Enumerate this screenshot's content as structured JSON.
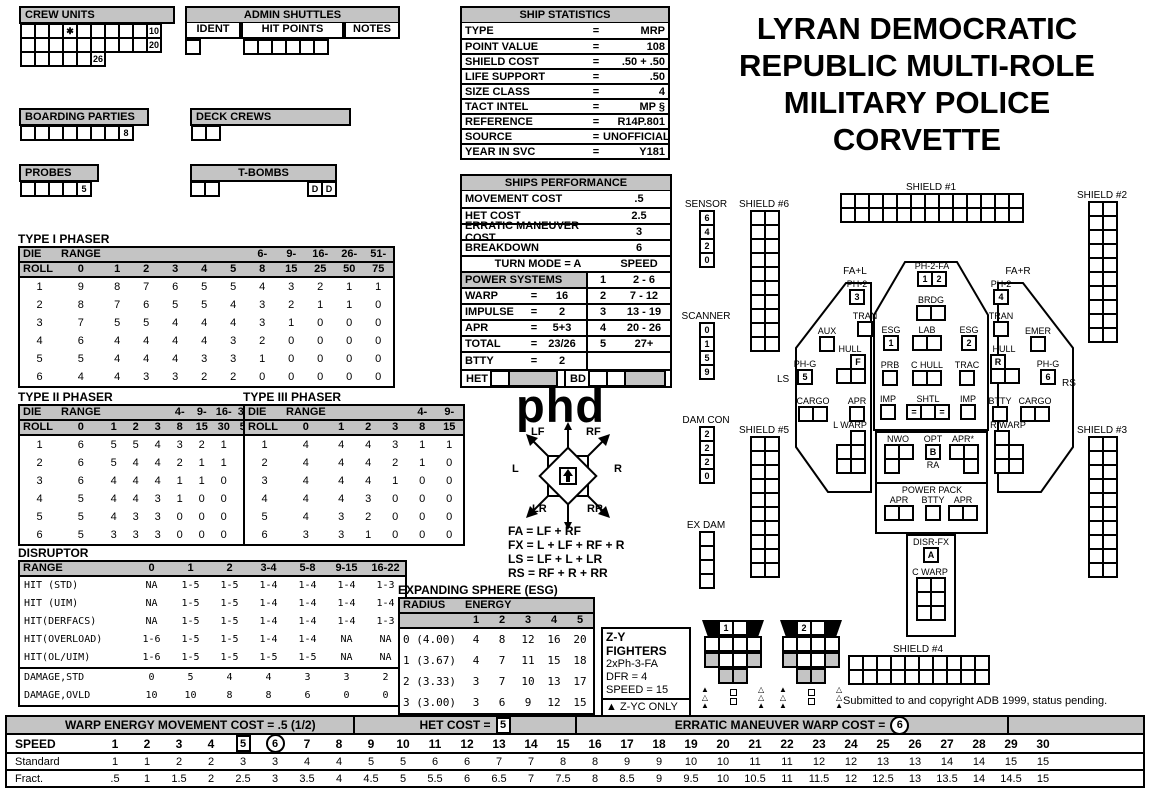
{
  "title_lines": [
    "LYRAN DEMOCRATIC",
    "REPUBLIC MULTI-ROLE",
    "MILITARY POLICE",
    "CORVETTE"
  ],
  "logo": "phd",
  "copyright": "Submitted to and copyright ADB 1999, status pending.",
  "panels": {
    "crew_units": {
      "title": "CREW UNITS",
      "row1": [
        "",
        "",
        "",
        "✱",
        "",
        "",
        "",
        "",
        "",
        "10"
      ],
      "row2": [
        "",
        "",
        "",
        "",
        "",
        "",
        "",
        "",
        "",
        "20"
      ],
      "row3": [
        "",
        "",
        "",
        "",
        "",
        "26"
      ]
    },
    "admin_shuttles": {
      "title": "ADMIN SHUTTLES",
      "col1": "IDENT",
      "col2": "HIT POINTS",
      "col3": "NOTES",
      "ident_cells": [
        ""
      ],
      "hit_cells": [
        "",
        "",
        "",
        "",
        "",
        ""
      ]
    },
    "boarding_parties": {
      "title": "BOARDING PARTIES",
      "cells": [
        "",
        "",
        "",
        "",
        "",
        "",
        "",
        "8"
      ]
    },
    "deck_crews": {
      "title": "DECK CREWS",
      "cells": [
        "",
        ""
      ]
    },
    "probes": {
      "title": "PROBES",
      "cells": [
        "",
        "",
        "",
        "",
        "5"
      ]
    },
    "t_bombs": {
      "title": "T-BOMBS",
      "left": [
        "",
        ""
      ],
      "right": [
        "D",
        "D"
      ]
    }
  },
  "ship_stats": {
    "title": "SHIP STATISTICS",
    "rows": [
      [
        "TYPE",
        "=",
        "MRP"
      ],
      [
        "POINT VALUE",
        "=",
        "108"
      ],
      [
        "SHIELD COST",
        "=",
        ".50 + .50"
      ],
      [
        "LIFE SUPPORT",
        "=",
        ".50"
      ],
      [
        "SIZE CLASS",
        "=",
        "4"
      ],
      [
        "TACT INTEL",
        "=",
        "MP §"
      ],
      [
        "REFERENCE",
        "=",
        "R14P.801"
      ],
      [
        "SOURCE",
        "=",
        "UNOFFICIAL"
      ],
      [
        "YEAR IN SVC",
        "=",
        "Y181"
      ]
    ]
  },
  "performance": {
    "title": "SHIPS PERFORMANCE",
    "rows": [
      [
        "MOVEMENT COST",
        ".5"
      ],
      [
        "HET COST",
        "2.5"
      ],
      [
        "ERRATIC MANEUVER COST",
        "3"
      ],
      [
        "BREAKDOWN",
        "6"
      ]
    ],
    "turn_mode": "TURN MODE = A",
    "speed": "SPEED",
    "power_header": "POWER SYSTEMS",
    "power_rows": [
      [
        "WARP",
        "=",
        "16"
      ],
      [
        "IMPULSE",
        "=",
        "2"
      ],
      [
        "APR",
        "=",
        "5+3"
      ],
      [
        "TOTAL",
        "=",
        "23/26"
      ],
      [
        "BTTY",
        "=",
        "2"
      ]
    ],
    "turn_rows": [
      [
        "1",
        "2 - 6"
      ],
      [
        "2",
        "7 - 12"
      ],
      [
        "3",
        "13 - 19"
      ],
      [
        "4",
        "20 - 26"
      ],
      [
        "5",
        "27+"
      ]
    ],
    "het": "HET",
    "bd": "BD"
  },
  "phaser1": {
    "title": "TYPE I PHASER",
    "ht": [
      "DIE",
      "RANGE",
      "",
      "",
      "",
      "",
      "",
      "6-",
      "9-",
      "16-",
      "26-",
      "51-"
    ],
    "hb": [
      "ROLL",
      "0",
      "1",
      "2",
      "3",
      "4",
      "5",
      "8",
      "15",
      "25",
      "50",
      "75"
    ],
    "rows": [
      [
        "1",
        "9",
        "8",
        "7",
        "6",
        "5",
        "5",
        "4",
        "3",
        "2",
        "1",
        "1"
      ],
      [
        "2",
        "8",
        "7",
        "6",
        "5",
        "5",
        "4",
        "3",
        "2",
        "1",
        "1",
        "0"
      ],
      [
        "3",
        "7",
        "5",
        "5",
        "4",
        "4",
        "4",
        "3",
        "1",
        "0",
        "0",
        "0"
      ],
      [
        "4",
        "6",
        "4",
        "4",
        "4",
        "4",
        "3",
        "2",
        "0",
        "0",
        "0",
        "0"
      ],
      [
        "5",
        "5",
        "4",
        "4",
        "4",
        "3",
        "3",
        "1",
        "0",
        "0",
        "0",
        "0"
      ],
      [
        "6",
        "4",
        "4",
        "3",
        "3",
        "2",
        "2",
        "0",
        "0",
        "0",
        "0",
        "0"
      ]
    ]
  },
  "phaser2": {
    "title": "TYPE II PHASER",
    "ht": [
      "DIE",
      "RANGE",
      "",
      "",
      "",
      "4-",
      "9-",
      "16-",
      "31-"
    ],
    "hb": [
      "ROLL",
      "0",
      "1",
      "2",
      "3",
      "8",
      "15",
      "30",
      "50"
    ],
    "rows": [
      [
        "1",
        "6",
        "5",
        "5",
        "4",
        "3",
        "2",
        "1",
        "1"
      ],
      [
        "2",
        "6",
        "5",
        "4",
        "4",
        "2",
        "1",
        "1",
        "0"
      ],
      [
        "3",
        "6",
        "4",
        "4",
        "4",
        "1",
        "1",
        "0",
        "0"
      ],
      [
        "4",
        "5",
        "4",
        "4",
        "3",
        "1",
        "0",
        "0",
        "0"
      ],
      [
        "5",
        "5",
        "4",
        "3",
        "3",
        "0",
        "0",
        "0",
        "0"
      ],
      [
        "6",
        "5",
        "3",
        "3",
        "3",
        "0",
        "0",
        "0",
        "0"
      ]
    ]
  },
  "phaser3": {
    "title": "TYPE III PHASER",
    "ht": [
      "DIE",
      "RANGE",
      "",
      "",
      "",
      "4-",
      "9-"
    ],
    "hb": [
      "ROLL",
      "0",
      "1",
      "2",
      "3",
      "8",
      "15"
    ],
    "rows": [
      [
        "1",
        "4",
        "4",
        "4",
        "3",
        "1",
        "1"
      ],
      [
        "2",
        "4",
        "4",
        "4",
        "2",
        "1",
        "0"
      ],
      [
        "3",
        "4",
        "4",
        "4",
        "1",
        "0",
        "0"
      ],
      [
        "4",
        "4",
        "4",
        "3",
        "0",
        "0",
        "0"
      ],
      [
        "5",
        "4",
        "3",
        "2",
        "0",
        "0",
        "0"
      ],
      [
        "6",
        "3",
        "3",
        "1",
        "0",
        "0",
        "0"
      ]
    ]
  },
  "disruptor": {
    "title": "DISRUPTOR",
    "sep": 5,
    "headers": [
      "RANGE",
      "0",
      "1",
      "2",
      "3-4",
      "5-8",
      "9-15",
      "16-22"
    ],
    "rows": [
      [
        "HIT (STD)",
        "NA",
        "1-5",
        "1-5",
        "1-4",
        "1-4",
        "1-4",
        "1-3"
      ],
      [
        "HIT (UIM)",
        "NA",
        "1-5",
        "1-5",
        "1-4",
        "1-4",
        "1-4",
        "1-4"
      ],
      [
        "HIT(DERFACS)",
        "NA",
        "1-5",
        "1-5",
        "1-4",
        "1-4",
        "1-4",
        "1-3"
      ],
      [
        "HIT(OVERLOAD)",
        "1-6",
        "1-5",
        "1-5",
        "1-4",
        "1-4",
        "NA",
        "NA"
      ],
      [
        "HIT(OL/UIM)",
        "1-6",
        "1-5",
        "1-5",
        "1-5",
        "1-5",
        "NA",
        "NA"
      ],
      [
        "DAMAGE,STD",
        "0",
        "5",
        "4",
        "4",
        "3",
        "3",
        "2"
      ],
      [
        "DAMAGE,OVLD",
        "10",
        "10",
        "8",
        "8",
        "6",
        "0",
        "0"
      ]
    ]
  },
  "esg": {
    "title": "EXPANDING SPHERE (ESG)",
    "h1": "RADIUS",
    "h2": "ENERGY",
    "cols": [
      "1",
      "2",
      "3",
      "4",
      "5"
    ],
    "rows": [
      [
        "0 (4.00)",
        "4",
        "8",
        "12",
        "16",
        "20"
      ],
      [
        "1 (3.67)",
        "4",
        "7",
        "11",
        "15",
        "18"
      ],
      [
        "2 (3.33)",
        "3",
        "7",
        "10",
        "13",
        "17"
      ],
      [
        "3 (3.00)",
        "3",
        "6",
        "9",
        "12",
        "15"
      ]
    ]
  },
  "rose": {
    "lf": "LF",
    "rf": "RF",
    "l": "L",
    "r": "R",
    "lr": "LR",
    "rr": "RR"
  },
  "formulas": [
    "FA = LF + RF",
    "FX = L + LF + RF + R",
    "LS = LF + L + LR",
    "RS = RF + R + RR"
  ],
  "trackers": {
    "sensor": {
      "label": "SENSOR",
      "grid": {
        "cols": 1,
        "rows": 4,
        "values": [
          "6",
          "4",
          "2",
          "0"
        ]
      }
    },
    "scanner": {
      "label": "SCANNER",
      "grid": {
        "cols": 1,
        "rows": 4,
        "values": [
          "0",
          "1",
          "5",
          "9"
        ]
      }
    },
    "dam_con": {
      "label": "DAM CON",
      "grid": {
        "cols": 1,
        "rows": 4,
        "values": [
          "2",
          "2",
          "2",
          "0"
        ]
      }
    },
    "ex_dam": {
      "label": "EX DAM",
      "grid": {
        "cols": 1,
        "rows": 4,
        "values": [
          "",
          "",
          "",
          ""
        ]
      }
    }
  },
  "shields": {
    "s1": {
      "label": "SHIELD #1",
      "grid": {
        "cols": 13,
        "rows": 2
      }
    },
    "s2": {
      "label": "SHIELD #2",
      "grid": {
        "cols": 2,
        "rows": 10
      }
    },
    "s3": {
      "label": "SHIELD #3",
      "grid": {
        "cols": 2,
        "rows": 10
      }
    },
    "s4": {
      "label": "SHIELD #4",
      "grid": {
        "cols": 10,
        "rows": 2
      }
    },
    "s5": {
      "label": "SHIELD #5",
      "grid": {
        "cols": 2,
        "rows": 10
      }
    },
    "s6": {
      "label": "SHIELD #6",
      "grid": {
        "cols": 2,
        "rows": 10
      }
    }
  },
  "ship": {
    "arc_fal": "FA+L",
    "arc_far": "FA+R",
    "ls": "LS",
    "rs": "RS",
    "ph2_l": {
      "label": "PH-2",
      "cells": [
        "3"
      ]
    },
    "tran_l": {
      "label": "TRAN",
      "cells": [
        ""
      ]
    },
    "aux": {
      "label": "AUX",
      "cells": [
        ""
      ]
    },
    "hull_l": {
      "label": "HULL",
      "grid": {
        "cols": 2,
        "rows": 2,
        "values": [
          null,
          "F",
          "",
          ""
        ]
      }
    },
    "phg_l": {
      "label": "PH-G",
      "cells": [
        "5"
      ]
    },
    "cargo_l": {
      "label": "CARGO",
      "cells": [
        "",
        ""
      ]
    },
    "apr_l": {
      "label": "APR",
      "cells": [
        ""
      ]
    },
    "lwarp": {
      "label": "L WARP",
      "grid": {
        "cols": 2,
        "rows": 3,
        "values": [
          null,
          "",
          "",
          "",
          "",
          ""
        ]
      }
    },
    "ph2fa": {
      "label": "PH-2-FA",
      "cells": [
        "1",
        "2"
      ]
    },
    "brdg": {
      "label": "BRDG",
      "cells": [
        "",
        ""
      ]
    },
    "esg1": {
      "label": "ESG",
      "cells": [
        "1"
      ]
    },
    "lab": {
      "label": "LAB",
      "cells": [
        "",
        ""
      ]
    },
    "esg2": {
      "label": "ESG",
      "cells": [
        "2"
      ]
    },
    "prb": {
      "label": "PRB",
      "cells": [
        ""
      ]
    },
    "chull": {
      "label": "C HULL",
      "cells": [
        "",
        ""
      ]
    },
    "trac": {
      "label": "TRAC",
      "cells": [
        ""
      ]
    },
    "imp_l": {
      "label": "IMP",
      "cells": [
        ""
      ]
    },
    "shtl": {
      "label": "SHTL",
      "cells": [
        "=",
        "",
        "="
      ]
    },
    "imp_r": {
      "label": "IMP",
      "cells": [
        ""
      ]
    },
    "nwo": {
      "label": "NWO",
      "grid": {
        "cols": 2,
        "rows": 2,
        "values": [
          "",
          "",
          "",
          null
        ]
      }
    },
    "opt": {
      "label": "OPT",
      "cells": [
        "B"
      ],
      "sub": "RA"
    },
    "apr_star": {
      "label": "APR*",
      "grid": {
        "cols": 2,
        "rows": 2,
        "values": [
          "",
          "",
          null,
          ""
        ]
      }
    },
    "power_pack": {
      "label": "POWER PACK",
      "apr1": {
        "label": "APR",
        "cells": [
          "",
          ""
        ]
      },
      "btty": {
        "label": "BTTY",
        "cells": [
          ""
        ]
      },
      "apr2": {
        "label": "APR",
        "cells": [
          "",
          ""
        ]
      }
    },
    "disr_fx": {
      "label": "DISR-FX",
      "cells": [
        "A"
      ]
    },
    "cwarp": {
      "label": "C WARP",
      "grid": {
        "cols": 2,
        "rows": 3,
        "values": [
          "",
          "",
          "",
          "",
          "",
          ""
        ]
      }
    },
    "ph2_r": {
      "label": "PH-2",
      "cells": [
        "4"
      ]
    },
    "tran_r": {
      "label": "TRAN",
      "cells": [
        ""
      ]
    },
    "emer": {
      "label": "EMER",
      "cells": [
        ""
      ]
    },
    "hull_r": {
      "label": "HULL",
      "grid": {
        "cols": 2,
        "rows": 2,
        "values": [
          "R",
          null,
          "",
          ""
        ]
      }
    },
    "phg_r": {
      "label": "PH-G",
      "cells": [
        "6"
      ]
    },
    "btty_r": {
      "label": "BTTY",
      "cells": [
        ""
      ]
    },
    "cargo_r": {
      "label": "CARGO",
      "cells": [
        "",
        ""
      ]
    },
    "rwarp": {
      "label": "R WARP",
      "grid": {
        "cols": 2,
        "rows": 3,
        "values": [
          "",
          null,
          "",
          "",
          "",
          ""
        ]
      }
    }
  },
  "fighters": {
    "title": "Z-Y FIGHTERS",
    "l1": "2xPh-3-FA",
    "l2": "DFR = 4",
    "l3": "SPEED = 15",
    "note_icon": "▲",
    "note": "Z-YC ONLY",
    "units": [
      "1",
      "2"
    ],
    "marks_left": [
      "▲",
      "△",
      "▲"
    ],
    "marks_right": [
      "△",
      "△",
      "▲"
    ]
  },
  "speed_chart": {
    "seg1": "WARP ENERGY MOVEMENT COST = .5  (1/2)",
    "seg2_label": "HET COST =",
    "seg2_value": "5",
    "seg3_label": "ERRATIC MANEUVER WARP COST =",
    "seg3_value": "6",
    "speed_label": "SPEED",
    "boxed": "5",
    "circled": "6",
    "speeds": [
      "1",
      "2",
      "3",
      "4",
      "5",
      "6",
      "7",
      "8",
      "9",
      "10",
      "11",
      "12",
      "13",
      "14",
      "15",
      "16",
      "17",
      "18",
      "19",
      "20",
      "21",
      "22",
      "23",
      "24",
      "25",
      "26",
      "27",
      "28",
      "29",
      "30"
    ],
    "row1_label": "Standard",
    "row1": [
      "1",
      "1",
      "2",
      "2",
      "3",
      "3",
      "4",
      "4",
      "5",
      "5",
      "6",
      "6",
      "7",
      "7",
      "8",
      "8",
      "9",
      "9",
      "10",
      "10",
      "11",
      "11",
      "12",
      "12",
      "13",
      "13",
      "14",
      "14",
      "15",
      "15"
    ],
    "row2_label": "Fract.",
    "row2": [
      ".5",
      "1",
      "1.5",
      "2",
      "2.5",
      "3",
      "3.5",
      "4",
      "4.5",
      "5",
      "5.5",
      "6",
      "6.5",
      "7",
      "7.5",
      "8",
      "8.5",
      "9",
      "9.5",
      "10",
      "10.5",
      "11",
      "11.5",
      "12",
      "12.5",
      "13",
      "13.5",
      "14",
      "14.5",
      "15"
    ]
  }
}
